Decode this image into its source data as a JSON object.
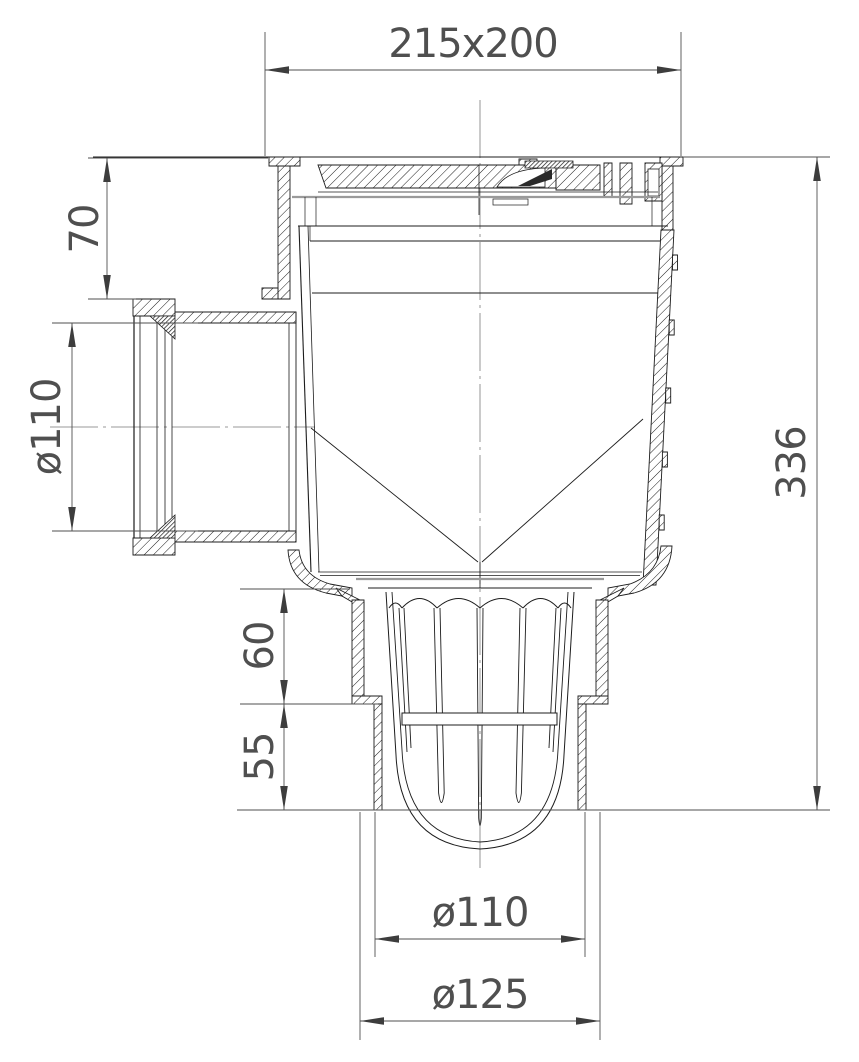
{
  "drawing": {
    "background_color": "#ffffff",
    "line_color": "#1c1c1c",
    "dimension_color": "#4f4f4f",
    "dimensions": {
      "top_frame": "215x200",
      "lid_height": "70",
      "inlet_pipe_diameter": "ø110",
      "overall_height": "336",
      "outlet_upper_step": "60",
      "outlet_lower_step": "55",
      "outlet_pipe_diameter": "ø110",
      "outlet_collar_diameter": "ø125"
    }
  }
}
